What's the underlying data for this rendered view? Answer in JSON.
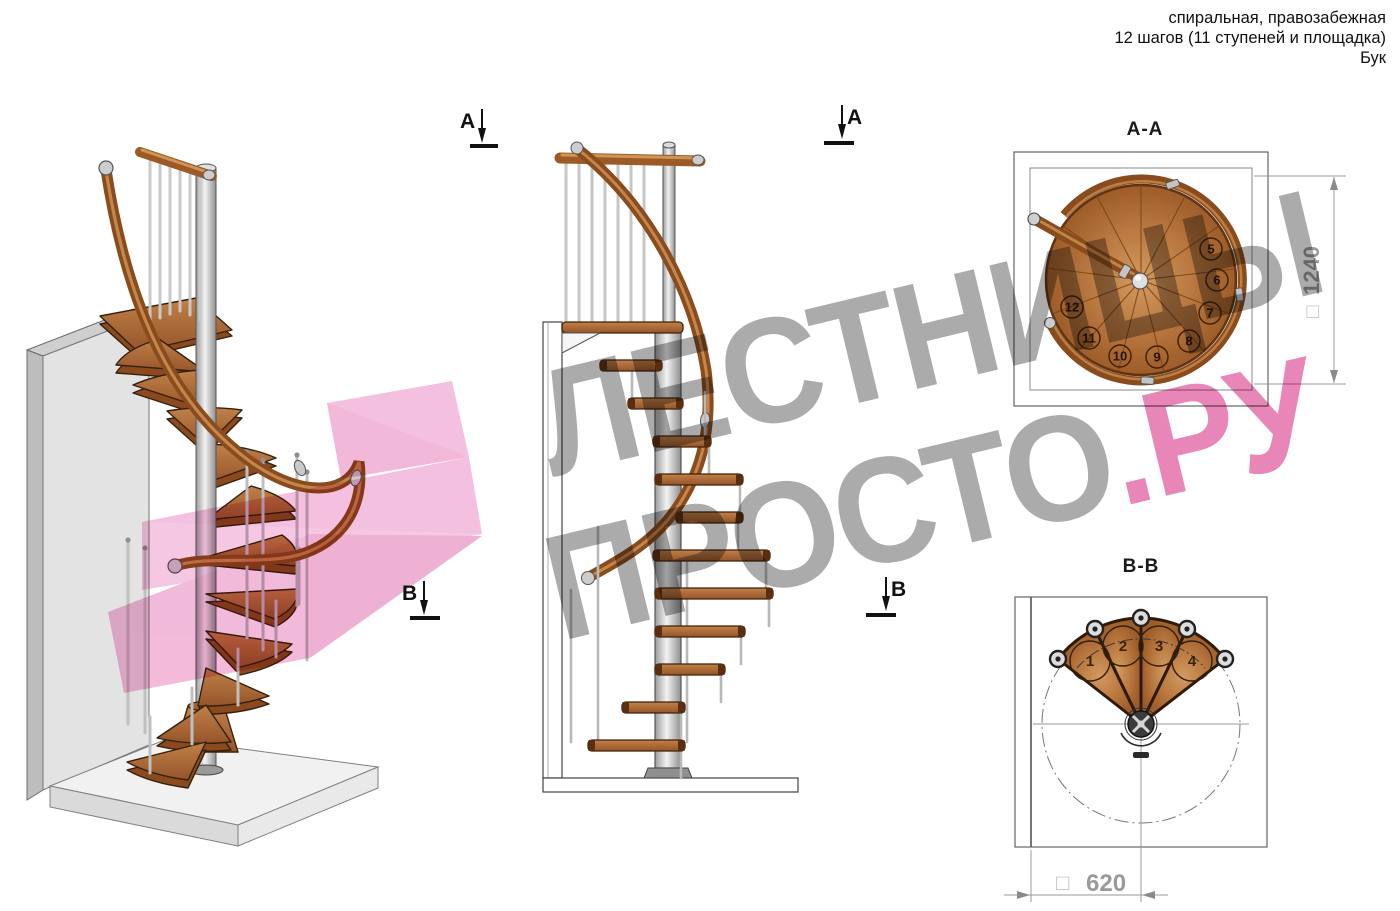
{
  "header": {
    "line1": "спиральная, правозабежная",
    "line2": "12 шагов (11 ступеней и площадка)",
    "line3": "Бук"
  },
  "markers": {
    "a": "A",
    "b": "B"
  },
  "watermark": {
    "line1": "ЛЕСТНИЦЫ",
    "line2_gray": "ПРОСТО",
    "line2_pink": ".РУ",
    "gray_color": "#ababab",
    "pink_color": "#e886b8",
    "logo_pink_color": "#f2b3d8"
  },
  "plan_a": {
    "title": "A-A",
    "steps": [
      "5",
      "6",
      "7",
      "8",
      "9",
      "10",
      "11",
      "12"
    ],
    "dimension": {
      "symbol": "□",
      "value": "1240"
    }
  },
  "plan_b": {
    "title": "B-B",
    "steps": [
      "1",
      "2",
      "3",
      "4"
    ],
    "dimension": {
      "symbol": "□",
      "value": "620"
    }
  },
  "materials": {
    "wood_color": "#b5763f",
    "metal_color": "#c8c8c8"
  }
}
